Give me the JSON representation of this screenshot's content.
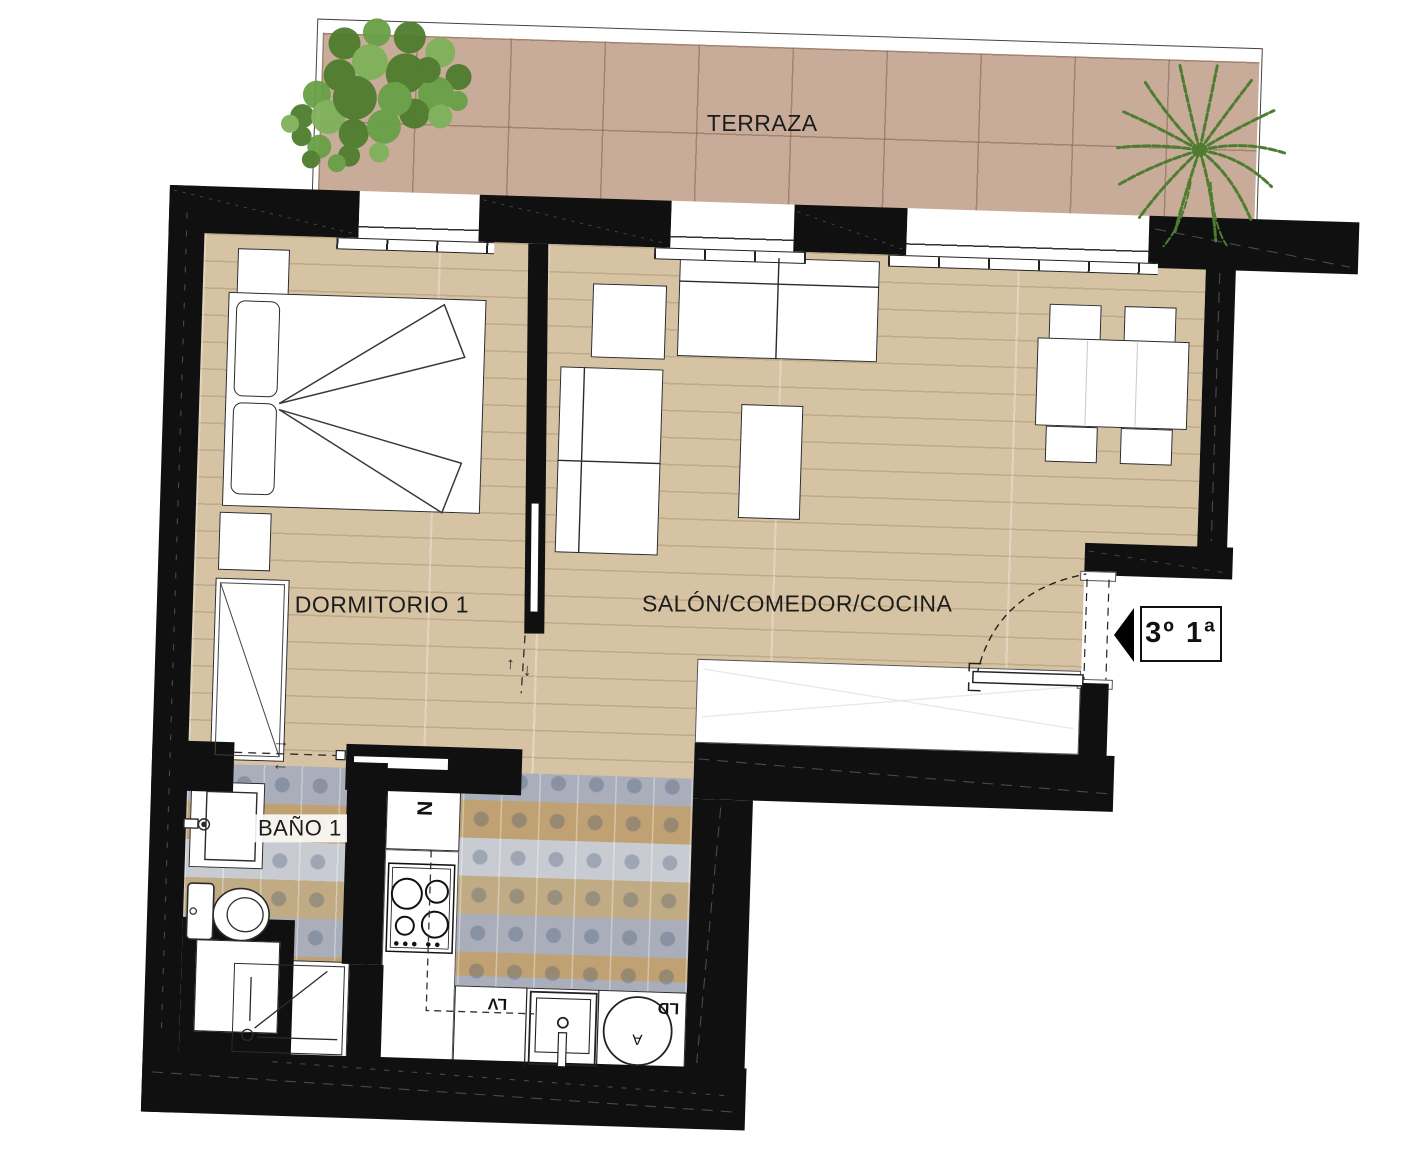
{
  "unit_badge": {
    "text": "3º 1ª"
  },
  "rooms": {
    "terraza": {
      "label": "TERRAZA"
    },
    "dormitorio1": {
      "label": "DORMITORIO 1"
    },
    "salon": {
      "label": "SALÓN/COMEDOR/COCINA"
    },
    "bano1": {
      "label": "BAÑO 1"
    }
  },
  "kitchen": {
    "fridge_label": "N",
    "dishwasher_label": "LV",
    "washer_label": "LD",
    "washer_drum_label": "A"
  },
  "door_arrows": {
    "right": "→",
    "left": "←",
    "up": "↑",
    "down": "↓"
  },
  "colors": {
    "wall": "#101010",
    "wood_floor": "#d6c3a3",
    "terrace_tile": "#c9ab99",
    "bath_tile_blue": "#a9aeba",
    "bath_tile_tan": "#bfa173",
    "plant_green": "#4e7d31",
    "line": "#2e2e2e"
  }
}
